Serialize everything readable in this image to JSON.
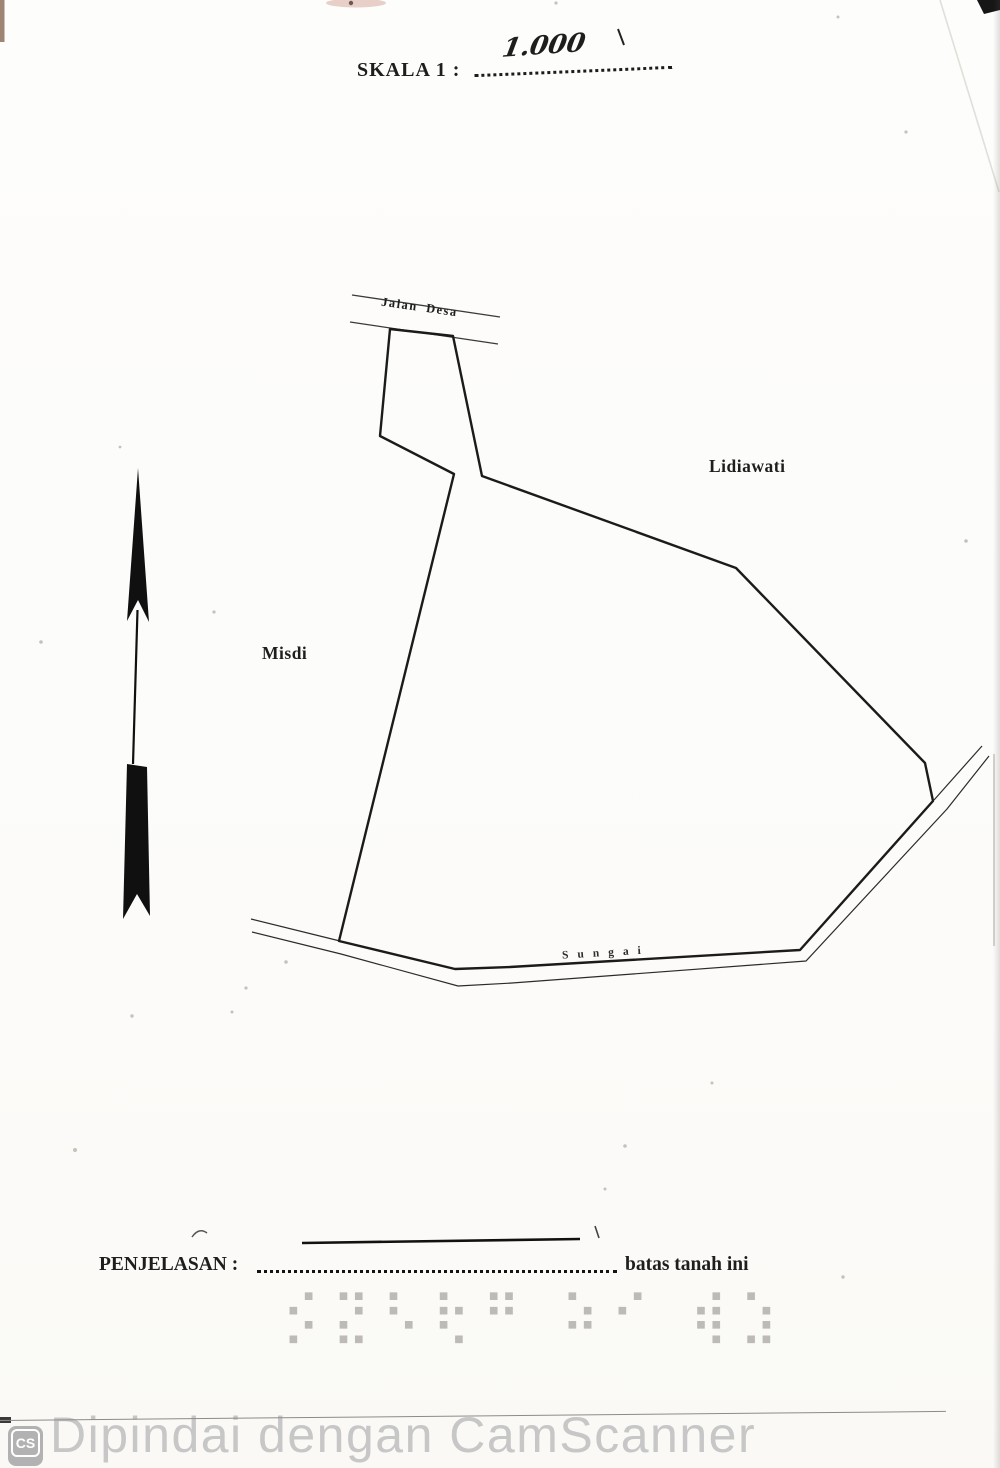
{
  "scale": {
    "label": "SKALA  1  :",
    "value": "1.000"
  },
  "map": {
    "road_label": "Jalan  Desa",
    "neighbor_east": "Lidiawati",
    "neighbor_west": "Misdi",
    "river_label": "Sungai"
  },
  "legend": {
    "label": "PENJELASAN  :",
    "value": "batas tanah ini"
  },
  "stamp": {
    "marks": "⡪⣝⠣⢗⠛ ⠵⠊ ⢾⣱"
  },
  "watermark": {
    "text": "Dipindai dengan CamScanner",
    "logo": "CS"
  },
  "colors": {
    "ink": "#1e1e1e",
    "watermark_gray": "#c7c7c7"
  }
}
